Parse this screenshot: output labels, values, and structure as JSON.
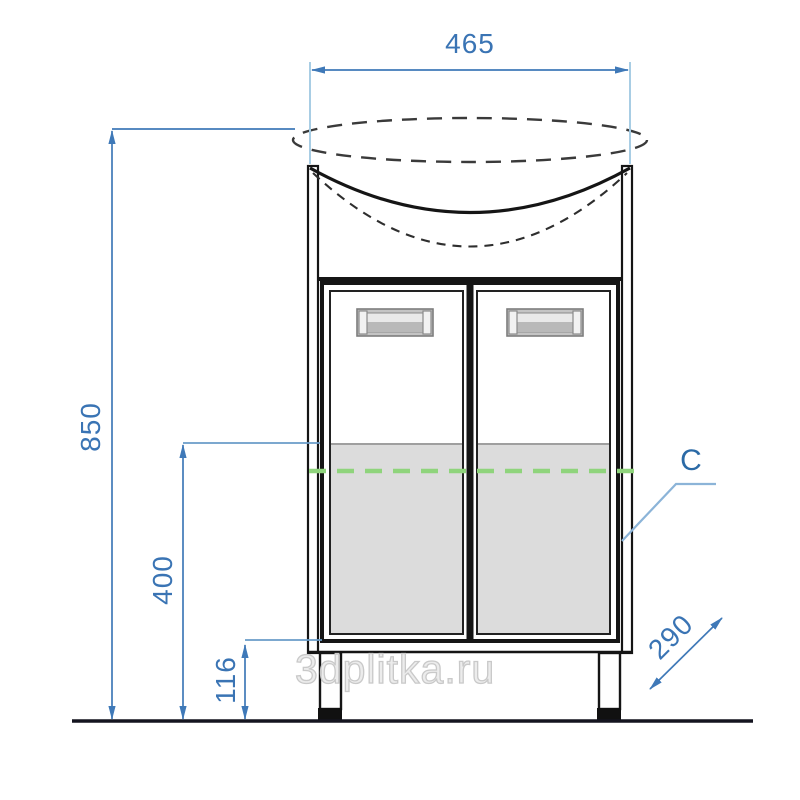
{
  "drawing": {
    "title": "vanity-cabinet-front-elevation",
    "dimensions": {
      "width_top_mm": "465",
      "height_total_mm": "850",
      "height_mid_mm": "400",
      "height_plinth_mm": "116",
      "depth_mm": "290"
    },
    "labels": {
      "section_mark": "C"
    },
    "watermark": "3dplitka.ru",
    "colors": {
      "dimension_blue": "#3a74b4",
      "extension_light_blue": "#8fb6da",
      "leader_blue": "#8cb4d8",
      "green_marker": "#8fd47c",
      "cabinet_line": "#151515",
      "door_shade_gray": "#dcdcdc",
      "floor_line": "#14141f",
      "watermark_gray": "#c9c9c9"
    }
  }
}
